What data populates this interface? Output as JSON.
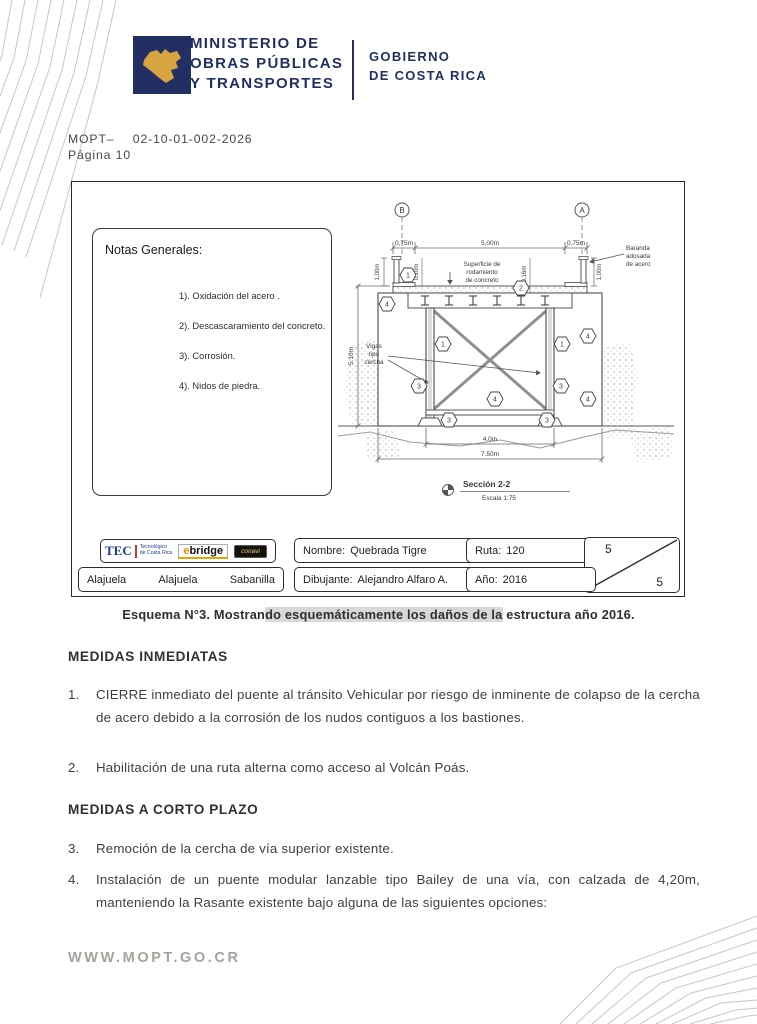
{
  "header": {
    "ministry_lines": [
      "MINISTERIO DE",
      "OBRAS PÚBLICAS",
      "Y TRANSPORTES"
    ],
    "government_lines": [
      "GOBIERNO",
      "DE COSTA RICA"
    ],
    "doc_ref_prefix": "MOPT–",
    "doc_ref_number": "02-10-01-002-2026",
    "page_label": "Página 10",
    "brand_navy": "#232f64",
    "brand_gold": "#d8a440"
  },
  "drawing": {
    "notes": {
      "title": "Notas Generales:",
      "items": [
        "1). Oxidación del acero .",
        "2). Descascaramiento del concreto.",
        "3). Corrosión.",
        "4). Nidos de piedra."
      ]
    },
    "grid": {
      "left": "B",
      "right": "A"
    },
    "dims": {
      "curb_left": "0,75m",
      "deck": "5,00m",
      "curb_right": "0,75m",
      "rail_left": "1,00m",
      "rail_right": "1,00m",
      "slab": "0,10m",
      "pavement": "0,16m",
      "height": "5.10m",
      "span": "4.0m",
      "total": "7.50m"
    },
    "notes_labels": {
      "surface": [
        "Superficie de",
        "rodamiento",
        "de concreto"
      ],
      "baranda": [
        "Baranda",
        "adosada",
        "de acero"
      ],
      "vigas": [
        "Vigas",
        "tipo",
        "cercha"
      ]
    },
    "hex": {
      "n1": "1",
      "n2": "2",
      "n3": "3",
      "n4": "4"
    },
    "section": {
      "title": "Sección 2-2",
      "scale": "Escala 1:75"
    },
    "titleblock": {
      "tec": "TEC",
      "tec_sub": [
        "Tecnológico",
        "de Costa Rica"
      ],
      "ebridge_e": "e",
      "ebridge_rest": "bridge",
      "partner": "conavi",
      "nombre_label": "Nombre:",
      "nombre_value": "Quebrada Tigre",
      "ruta_label": "Ruta:",
      "ruta_value": "120",
      "dibujante_label": "Dibujante:",
      "dibujante_value": "Alejandro Alfaro A.",
      "anio_label": "Año:",
      "anio_value": "2016",
      "locations": [
        "Alajuela",
        "Alajuela",
        "Sabanilla"
      ],
      "sheet_current": "5",
      "sheet_total": "5"
    }
  },
  "caption": {
    "pre": "Esquema N°3. Mostran",
    "highlight": "do esquemáticamente los daños de la",
    "post": " estructura año 2016."
  },
  "sections": [
    {
      "heading": "MEDIDAS INMEDIATAS",
      "items": [
        {
          "num": "1.",
          "text": "CIERRE inmediato del puente al tránsito Vehicular por riesgo de inminente de colapso de la cercha de acero debido a la corrosión de los nudos contiguos a los bastiones."
        },
        {
          "num": "2.",
          "text": "Habilitación de una ruta alterna como acceso al Volcán Poás."
        }
      ]
    },
    {
      "heading": "MEDIDAS A CORTO PLAZO",
      "items": [
        {
          "num": "3.",
          "text": "Remoción de la cercha de vía superior existente."
        },
        {
          "num": "4.",
          "text": "Instalación de un puente modular lanzable tipo Bailey de una vía, con calzada de 4,20m, manteniendo la Rasante existente bajo alguna de las siguientes opciones:"
        }
      ]
    }
  ],
  "footer": {
    "url": "WWW.MOPT.GO.CR"
  }
}
